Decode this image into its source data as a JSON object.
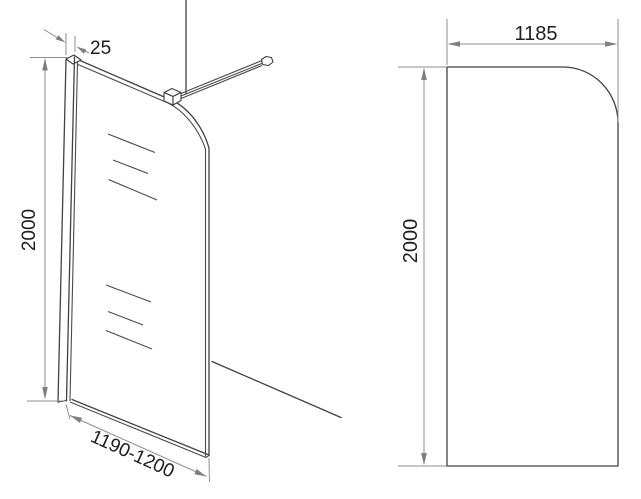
{
  "drawing": {
    "kind": "technical dimension drawing",
    "subject": "walk-in shower glass screen with wall profile and support bar",
    "background_color": "#ffffff",
    "object_line_color": "#414141",
    "dimension_line_color": "#8e8e8e",
    "text_color": "#1e1e1e",
    "perspective_view": {
      "profile_width_label": "25",
      "height_label": "2000",
      "width_range_label": "1190-1200"
    },
    "front_view": {
      "width_label": "1185",
      "height_label": "2000"
    }
  }
}
